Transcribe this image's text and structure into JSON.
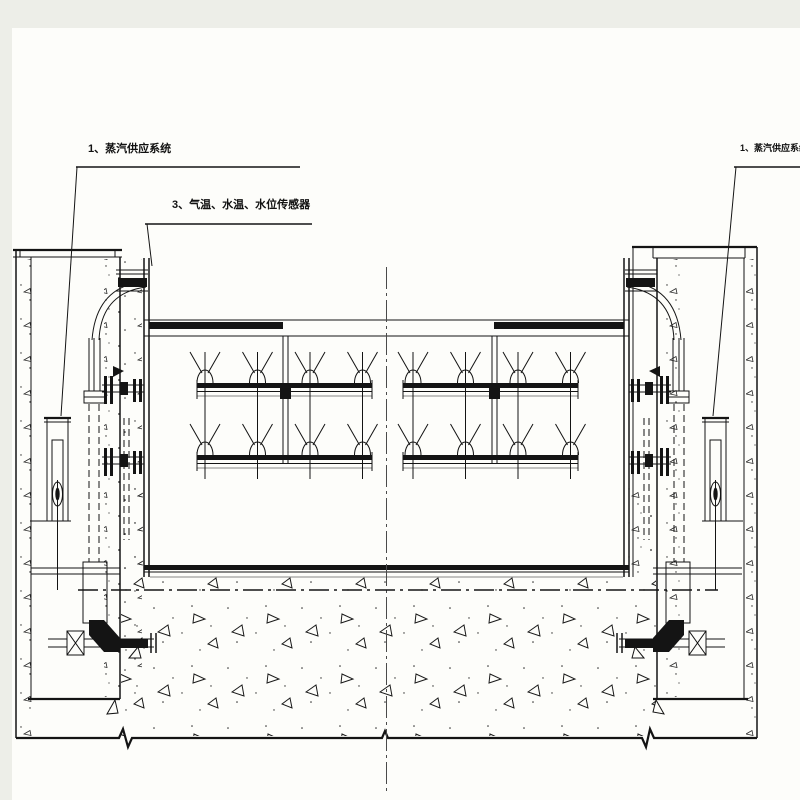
{
  "drawing": {
    "type": "engineering-cad-section",
    "colors": {
      "ink": "#141414",
      "page_bg": "#edeee8",
      "sheet_bg": "#fdfdfa",
      "centerline": "#4a4a4a"
    },
    "annotations": {
      "left_system": {
        "label": "1、蒸汽供应系统"
      },
      "sensors": {
        "label": "3、气温、水温、水位传感器"
      },
      "right_system": {
        "label": "1、蒸汽供应系统"
      }
    }
  }
}
